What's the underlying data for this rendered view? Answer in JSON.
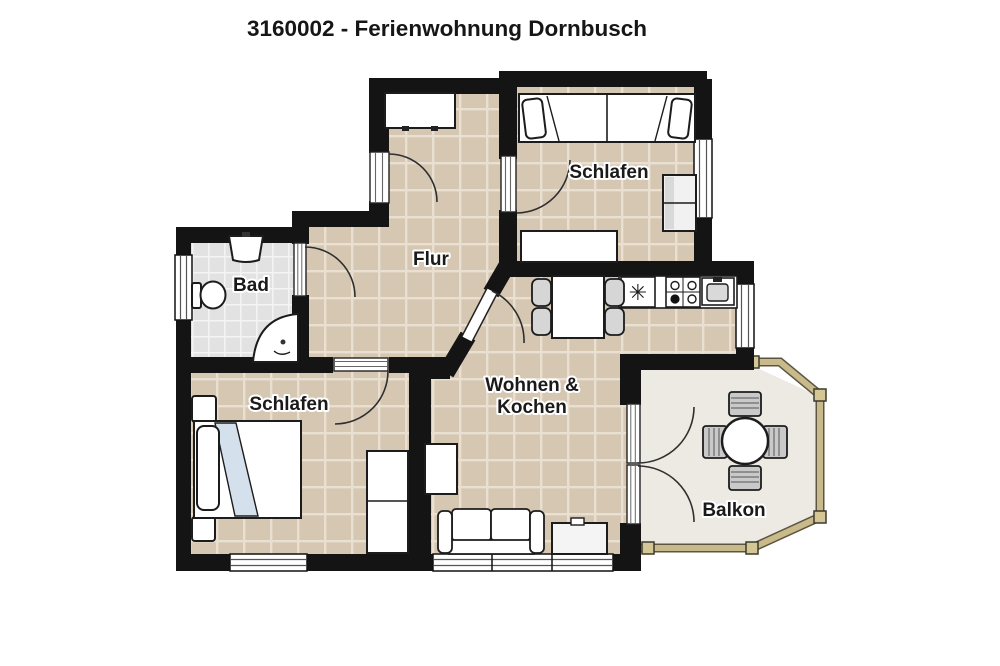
{
  "title": "3160002 - Ferienwohnung Dornbusch",
  "rooms": {
    "schlafen_top": {
      "label": "Schlafen"
    },
    "flur": {
      "label": "Flur"
    },
    "bad": {
      "label": "Bad"
    },
    "schlafen_bottom": {
      "label": "Schlafen"
    },
    "wohnen_kochen": {
      "label_line1": "Wohnen &",
      "label_line2": "Kochen"
    },
    "balkon": {
      "label": "Balkon"
    }
  },
  "symbols": {
    "freezer": "✳"
  },
  "colors": {
    "wall": "#141414",
    "floor_tile": "#d5c7b2",
    "floor_tile_line": "#e9e0d1",
    "floor_bath": "#e2e2e2",
    "floor_bath_line": "#f4f4f4",
    "floor_balcony": "#eceae3",
    "railing": "#c9ba8b",
    "railing_dark": "#5c5640",
    "blanket": "#d4e0ec"
  }
}
